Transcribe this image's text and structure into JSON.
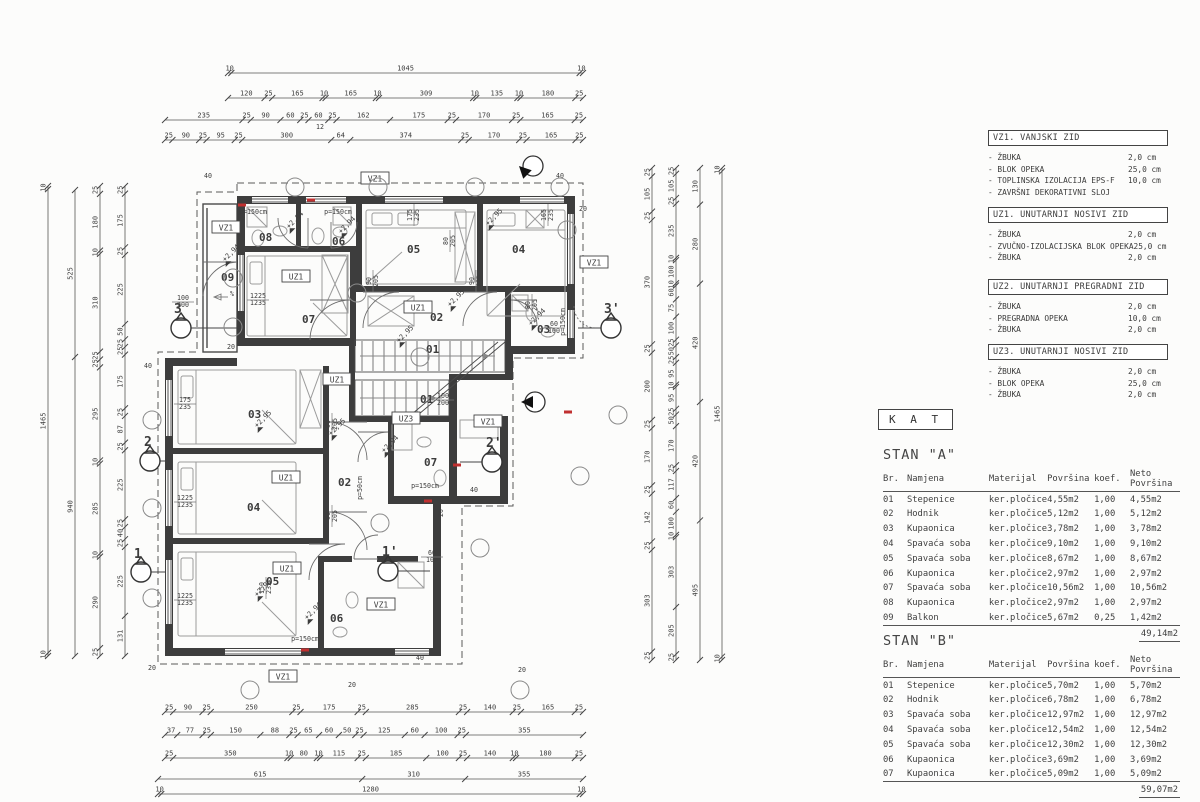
{
  "floor_label": "K A T",
  "legend_sections": [
    {
      "title": "VZ1. VANJSKI ZID",
      "top": 130,
      "items": [
        {
          "name": "-  ŽBUKA",
          "value": "2,0 cm"
        },
        {
          "name": "-  BLOK OPEKA",
          "value": "25,0 cm"
        },
        {
          "name": "-  TOPLINSKA IZOLACIJA EPS-F",
          "value": "10,0 cm"
        },
        {
          "name": "-  ZAVRŠNI DEKORATIVNI SLOJ",
          "value": ""
        }
      ]
    },
    {
      "title": "UZ1. UNUTARNJI NOSIVI ZID",
      "top": 207,
      "items": [
        {
          "name": "-  ŽBUKA",
          "value": "2,0 cm"
        },
        {
          "name": "-  ZVUČNO-IZOLACIJSKA BLOK OPEKA",
          "value": "25,0 cm"
        },
        {
          "name": "-  ŽBUKA",
          "value": "2,0 cm"
        }
      ]
    },
    {
      "title": "UZ2. UNUTARNJI PREGRADNI ZID",
      "top": 279,
      "items": [
        {
          "name": "-  ŽBUKA",
          "value": "2,0 cm"
        },
        {
          "name": "-  PREGRADNA OPEKA",
          "value": "10,0 cm"
        },
        {
          "name": "-  ŽBUKA",
          "value": "2,0 cm"
        }
      ]
    },
    {
      "title": "UZ3. UNUTARNJI NOSIVI ZID",
      "top": 344,
      "items": [
        {
          "name": "-  ŽBUKA",
          "value": "2,0 cm"
        },
        {
          "name": "-  BLOK OPEKA",
          "value": "25,0 cm"
        },
        {
          "name": "-  ŽBUKA",
          "value": "2,0 cm"
        }
      ]
    }
  ],
  "apartments": [
    {
      "title": "STAN \"A\"",
      "top": 447,
      "columns": [
        "Br.",
        "Namjena",
        "Materijal",
        "Površina",
        "koef.",
        "Neto Površina"
      ],
      "rows": [
        [
          "01",
          "Stepenice",
          "ker.pločice",
          "4,55m2",
          "1,00",
          "4,55m2"
        ],
        [
          "02",
          "Hodnik",
          "ker.pločice",
          "5,12m2",
          "1,00",
          "5,12m2"
        ],
        [
          "03",
          "Kupaonica",
          "ker.pločice",
          "3,78m2",
          "1,00",
          "3,78m2"
        ],
        [
          "04",
          "Spavaća soba",
          "ker.pločice",
          "9,10m2",
          "1,00",
          "9,10m2"
        ],
        [
          "05",
          "Spavaća soba",
          "ker.pločice",
          "8,67m2",
          "1,00",
          "8,67m2"
        ],
        [
          "06",
          "Kupaonica",
          "ker.pločice",
          "2,97m2",
          "1,00",
          "2,97m2"
        ],
        [
          "07",
          "Spavaća soba",
          "ker.pločice",
          "10,56m2",
          "1,00",
          "10,56m2"
        ],
        [
          "08",
          "Kupaonica",
          "ker.pločice",
          "2,97m2",
          "1,00",
          "2,97m2"
        ],
        [
          "09",
          "Balkon",
          "ker.pločice",
          "5,67m2",
          "0,25",
          "1,42m2"
        ]
      ],
      "total": "49,14m2"
    },
    {
      "title": "STAN \"B\"",
      "top": 633,
      "columns": [
        "Br.",
        "Namjena",
        "Materijal",
        "Površina",
        "koef.",
        "Neto Površina"
      ],
      "rows": [
        [
          "01",
          "Stepenice",
          "ker.pločice",
          "5,70m2",
          "1,00",
          "5,70m2"
        ],
        [
          "02",
          "Hodnik",
          "ker.pločice",
          "6,78m2",
          "1,00",
          "6,78m2"
        ],
        [
          "03",
          "Spavaća soba",
          "ker.pločice",
          "12,97m2",
          "1,00",
          "12,97m2"
        ],
        [
          "04",
          "Spavaća soba",
          "ker.pločice",
          "12,54m2",
          "1,00",
          "12,54m2"
        ],
        [
          "05",
          "Spavaća soba",
          "ker.pločice",
          "12,30m2",
          "1,00",
          "12,30m2"
        ],
        [
          "06",
          "Kupaonica",
          "ker.pločice",
          "3,69m2",
          "1,00",
          "3,69m2"
        ],
        [
          "07",
          "Kupaonica",
          "ker.pločice",
          "5,09m2",
          "1,00",
          "5,09m2"
        ]
      ],
      "total": "59,07m2"
    }
  ],
  "plan": {
    "room_numbers": [
      {
        "t": "08",
        "x": 259,
        "y": 241
      },
      {
        "t": "06",
        "x": 332,
        "y": 245
      },
      {
        "t": "05",
        "x": 407,
        "y": 253
      },
      {
        "t": "04",
        "x": 512,
        "y": 253
      },
      {
        "t": "09",
        "x": 221,
        "y": 281
      },
      {
        "t": "07",
        "x": 302,
        "y": 323
      },
      {
        "t": "02",
        "x": 430,
        "y": 321
      },
      {
        "t": "01",
        "x": 426,
        "y": 353
      },
      {
        "t": "03",
        "x": 537,
        "y": 333
      },
      {
        "t": "03",
        "x": 248,
        "y": 418
      },
      {
        "t": "04",
        "x": 247,
        "y": 511
      },
      {
        "t": "05",
        "x": 266,
        "y": 585
      },
      {
        "t": "02",
        "x": 338,
        "y": 486
      },
      {
        "t": "01",
        "x": 420,
        "y": 403
      },
      {
        "t": "07",
        "x": 424,
        "y": 466
      },
      {
        "t": "06",
        "x": 330,
        "y": 622
      }
    ],
    "wall_tags": [
      {
        "t": "VZ1",
        "x": 226,
        "y": 229
      },
      {
        "t": "VZ1",
        "x": 375,
        "y": 180
      },
      {
        "t": "VZ1",
        "x": 594,
        "y": 264
      },
      {
        "t": "VZ1",
        "x": 488,
        "y": 423
      },
      {
        "t": "VZ1",
        "x": 381,
        "y": 606
      },
      {
        "t": "VZ1",
        "x": 283,
        "y": 678
      },
      {
        "t": "UZ1",
        "x": 296,
        "y": 278
      },
      {
        "t": "UZ1",
        "x": 418,
        "y": 309
      },
      {
        "t": "UZ1",
        "x": 337,
        "y": 381
      },
      {
        "t": "UZ1",
        "x": 286,
        "y": 479
      },
      {
        "t": "UZ1",
        "x": 287,
        "y": 570
      },
      {
        "t": "UZ3",
        "x": 406,
        "y": 420
      }
    ],
    "level_marks": [
      {
        "t": "+2,94",
        "x": 225,
        "y": 262
      },
      {
        "t": "+2,94",
        "x": 289,
        "y": 229
      },
      {
        "t": "+2,94",
        "x": 341,
        "y": 234
      },
      {
        "t": "+2,95",
        "x": 488,
        "y": 226
      },
      {
        "t": "+2,95",
        "x": 450,
        "y": 307
      },
      {
        "t": "+2,94",
        "x": 531,
        "y": 326
      },
      {
        "t": "+2,95",
        "x": 399,
        "y": 343
      },
      {
        "t": "+2,95",
        "x": 257,
        "y": 428
      },
      {
        "t": "+2,95",
        "x": 331,
        "y": 436
      },
      {
        "t": "+2,94",
        "x": 384,
        "y": 453
      },
      {
        "t": "+2,95",
        "x": 257,
        "y": 597
      },
      {
        "t": "+2,94",
        "x": 307,
        "y": 620
      }
    ],
    "annotations": [
      {
        "t": "1225",
        "t2": "1235",
        "x": 258,
        "y": 298,
        "r": 0
      },
      {
        "t": "1225",
        "t2": "1235",
        "x": 185,
        "y": 500,
        "r": 0
      },
      {
        "t": "1225",
        "t2": "1235",
        "x": 185,
        "y": 598,
        "r": 0
      },
      {
        "t": "175",
        "t2": "235",
        "x": 185,
        "y": 402,
        "r": 0
      },
      {
        "t": "175",
        "t2": "235",
        "x": 412,
        "y": 215,
        "r": -90
      },
      {
        "t": "165",
        "t2": "235",
        "x": 546,
        "y": 215,
        "r": -90
      },
      {
        "t": "150",
        "t2": "235",
        "x": 264,
        "y": 588,
        "r": -90
      },
      {
        "t": "100",
        "t2": "200",
        "x": 443,
        "y": 398,
        "r": 0
      },
      {
        "t": "100",
        "t2": "200",
        "x": 183,
        "y": 300,
        "r": 0
      },
      {
        "t": "60",
        "t2": "100",
        "x": 554,
        "y": 326,
        "r": 0
      },
      {
        "t": "60",
        "t2": "100",
        "x": 432,
        "y": 555,
        "r": 0
      },
      {
        "t": "90",
        "t2": "205",
        "x": 371,
        "y": 281,
        "r": -90
      },
      {
        "t": "90",
        "t2": "205",
        "x": 474,
        "y": 281,
        "r": -90
      },
      {
        "t": "90",
        "t2": "205",
        "x": 330,
        "y": 424,
        "r": -90
      },
      {
        "t": "90",
        "t2": "205",
        "x": 330,
        "y": 516,
        "r": -90
      },
      {
        "t": "80",
        "t2": "205",
        "x": 448,
        "y": 241,
        "r": -90
      },
      {
        "t": "80",
        "t2": "205",
        "x": 530,
        "y": 305,
        "r": -90
      },
      {
        "t": "p=150cm",
        "x": 253,
        "y": 214,
        "r": 0
      },
      {
        "t": "p=150cm",
        "x": 338,
        "y": 214,
        "r": 0
      },
      {
        "t": "p=150cm",
        "x": 565,
        "y": 322,
        "r": -90
      },
      {
        "t": "p=150cm",
        "x": 425,
        "y": 488,
        "r": 0
      },
      {
        "t": "p=150cm",
        "x": 305,
        "y": 641,
        "r": 0
      },
      {
        "t": "p=50cm",
        "x": 362,
        "y": 488,
        "r": -90
      },
      {
        "t": "20",
        "x": 583,
        "y": 211,
        "r": 0
      },
      {
        "t": "20",
        "x": 231,
        "y": 349,
        "r": 0
      },
      {
        "t": "20",
        "x": 443,
        "y": 513,
        "r": -90
      },
      {
        "t": "20",
        "x": 352,
        "y": 687,
        "r": 0
      },
      {
        "t": "20",
        "x": 522,
        "y": 672,
        "r": 0
      },
      {
        "t": "20",
        "x": 152,
        "y": 670,
        "r": 0
      },
      {
        "t": "40",
        "x": 208,
        "y": 178,
        "r": 0
      },
      {
        "t": "40",
        "x": 560,
        "y": 178,
        "r": 0
      },
      {
        "t": "40",
        "x": 148,
        "y": 368,
        "r": 0
      },
      {
        "t": "40",
        "x": 474,
        "y": 492,
        "r": 0
      },
      {
        "t": "40",
        "x": 420,
        "y": 660,
        "r": 0
      },
      {
        "t": "12",
        "x": 320,
        "y": 129,
        "r": 0
      },
      {
        "t": "%",
        "x": 232,
        "y": 296,
        "r": 0
      }
    ],
    "section_markers": [
      {
        "t": "3",
        "lx": 174,
        "ly": 313,
        "cx": 181,
        "cy": 328,
        "dir": 1,
        "wx": 237
      },
      {
        "t": "2",
        "lx": 144,
        "ly": 446,
        "cx": 150,
        "cy": 461,
        "dir": 1,
        "wx": 165
      },
      {
        "t": "1",
        "lx": 134,
        "ly": 558,
        "cx": 141,
        "cy": 572,
        "dir": 1,
        "wx": 165
      },
      {
        "t": "3'",
        "lx": 604,
        "ly": 313,
        "cx": 611,
        "cy": 328,
        "dir": -1,
        "wx": 578
      },
      {
        "t": "2'",
        "lx": 486,
        "ly": 447,
        "cx": 492,
        "cy": 462,
        "dir": -1,
        "wx": 460
      },
      {
        "t": "1'",
        "lx": 382,
        "ly": 556,
        "cx": 388,
        "cy": 571,
        "dir": 1,
        "wx": 430
      }
    ],
    "view_arrows": [
      {
        "x": 519,
        "y": 166,
        "a": 225
      },
      {
        "x": 521,
        "y": 402,
        "a": 180
      }
    ],
    "leader_circles": [
      [
        295,
        187
      ],
      [
        378,
        187
      ],
      [
        475,
        187
      ],
      [
        560,
        187
      ],
      [
        233,
        278
      ],
      [
        233,
        327
      ],
      [
        357,
        293
      ],
      [
        420,
        357
      ],
      [
        480,
        548
      ],
      [
        380,
        523
      ],
      [
        250,
        690
      ],
      [
        520,
        690
      ],
      [
        152,
        420
      ],
      [
        152,
        508
      ],
      [
        152,
        598
      ],
      [
        580,
        476
      ],
      [
        618,
        415
      ],
      [
        567,
        230
      ]
    ],
    "red_ticks": [
      [
        242,
        205
      ],
      [
        311,
        200
      ],
      [
        568,
        412
      ],
      [
        428,
        501
      ],
      [
        305,
        650
      ],
      [
        457,
        465
      ]
    ]
  },
  "dimensions": {
    "top": [
      {
        "y": 73,
        "x1": 228,
        "x2": 583,
        "v": [
          "10",
          "1045",
          "10"
        ]
      },
      {
        "y": 98,
        "x1": 228,
        "x2": 583,
        "v": [
          "120",
          "25",
          "165",
          "10",
          "165",
          "10",
          "309",
          "10",
          "135",
          "10",
          "180",
          "25"
        ]
      },
      {
        "y": 120,
        "x1": 165,
        "x2": 583,
        "v": [
          "235",
          "25",
          "90",
          "60",
          "25",
          "60",
          "25",
          "162",
          "175",
          "25",
          "170",
          "25",
          "165",
          "25"
        ]
      },
      {
        "y": 140,
        "x1": 165,
        "x2": 583,
        "v": [
          "25",
          "90",
          "25",
          "95",
          "25",
          "300",
          "64",
          "374",
          "25",
          "170",
          "25",
          "165",
          "25"
        ]
      }
    ],
    "bottom": [
      {
        "y": 712,
        "x1": 165,
        "x2": 583,
        "v": [
          "25",
          "90",
          "25",
          "250",
          "25",
          "175",
          "25",
          "285",
          "25",
          "140",
          "25",
          "165",
          "25"
        ]
      },
      {
        "y": 735,
        "x1": 165,
        "x2": 583,
        "v": [
          "37",
          "77",
          "25",
          "150",
          "88",
          "25",
          "65",
          "60",
          "50",
          "25",
          "125",
          "60",
          "100",
          "25",
          "355"
        ]
      },
      {
        "y": 758,
        "x1": 165,
        "x2": 583,
        "v": [
          "25",
          "350",
          "10",
          "80",
          "10",
          "115",
          "25",
          "185",
          "100",
          "25",
          "140",
          "10",
          "180",
          "25"
        ]
      },
      {
        "y": 779,
        "x1": 158,
        "x2": 583,
        "v": [
          "615",
          "310",
          "355"
        ]
      },
      {
        "y": 794,
        "x1": 158,
        "x2": 583,
        "v": [
          "10",
          "1280",
          "10"
        ]
      }
    ],
    "left": [
      {
        "x": 48,
        "y1": 186,
        "y2": 656,
        "v": [
          "10",
          "1465",
          "10"
        ]
      },
      {
        "x": 75,
        "y1": 190,
        "y2": 656,
        "v": [
          "525",
          "940"
        ]
      },
      {
        "x": 100,
        "y1": 186,
        "y2": 656,
        "v": [
          "25",
          "180",
          "10",
          "310",
          "25",
          "25",
          "295",
          "10",
          "285",
          "10",
          "290",
          "25"
        ]
      },
      {
        "x": 125,
        "y1": 186,
        "y2": 656,
        "v": [
          "25",
          "175",
          "25",
          "225",
          "50",
          "25",
          "25",
          "175",
          "25",
          "87",
          "25",
          "225",
          "25",
          "40",
          "25",
          "225",
          "131"
        ]
      }
    ],
    "right": [
      {
        "x": 652,
        "y1": 168,
        "y2": 660,
        "v": [
          "25",
          "105",
          "25",
          "370",
          "25",
          "200",
          "25",
          "170",
          "25",
          "142",
          "25",
          "303",
          "25"
        ]
      },
      {
        "x": 676,
        "y1": 168,
        "y2": 660,
        "v": [
          "25",
          "105",
          "25",
          "235",
          "10",
          "100",
          "10",
          "60",
          "75",
          "100",
          "25",
          "50",
          "25",
          "95",
          "10",
          "95",
          "25",
          "50",
          "170",
          "25",
          "117",
          "60",
          "100",
          "10",
          "303",
          "205",
          "25"
        ]
      },
      {
        "x": 700,
        "y1": 168,
        "y2": 660,
        "v": [
          "130",
          "280",
          "420",
          "420",
          "495"
        ]
      },
      {
        "x": 722,
        "y1": 168,
        "y2": 660,
        "v": [
          "10",
          "1465",
          "10"
        ]
      }
    ]
  }
}
